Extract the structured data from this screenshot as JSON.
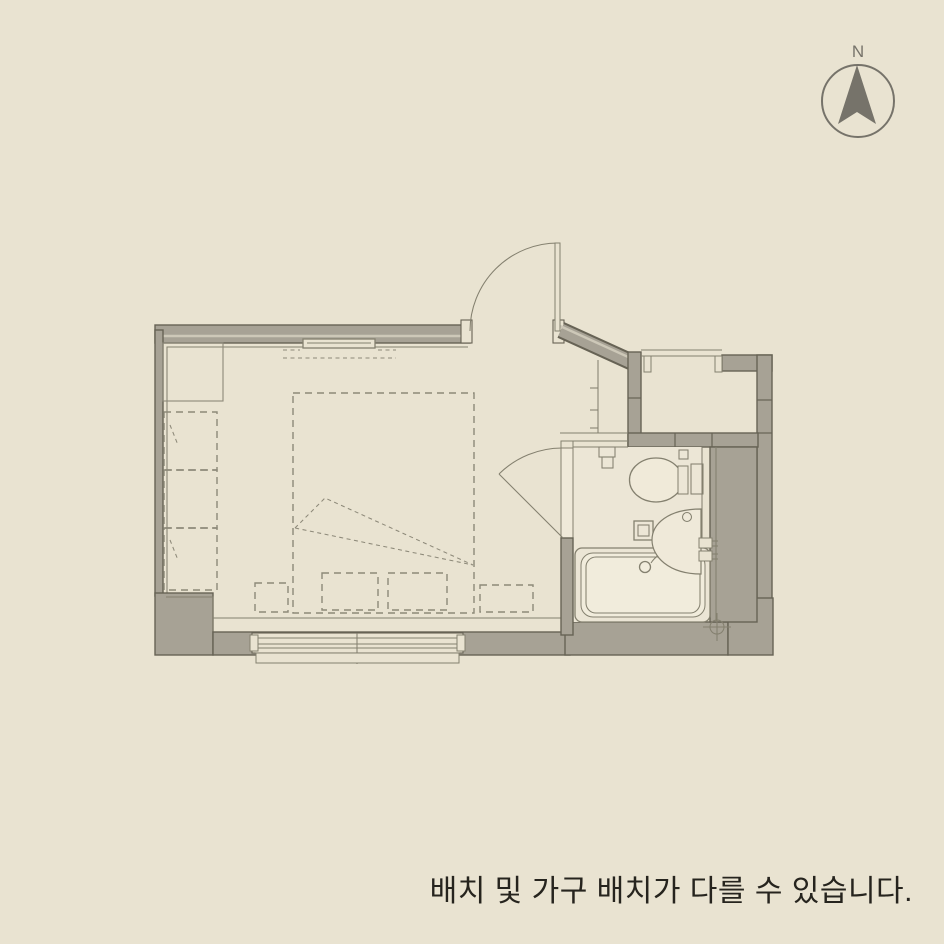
{
  "page": {
    "background_color": "#e9e3d1",
    "caption": "배치 및 가구 배치가 다를 수 있습니다.",
    "caption_color": "#26241e"
  },
  "compass": {
    "label": "N",
    "color": "#76736a"
  },
  "floor_plan": {
    "colors": {
      "wall-fill": "#a7a295",
      "wall-stroke": "#676355",
      "wall-inner-stripe": "#cdc8b8",
      "fixture-line": "#84806f",
      "fixture-fill": "#f0ead9",
      "dashed-line": "#8d8979",
      "bathroom-floor": "#ece6d6",
      "tub-fill": "#ebe5d5",
      "tub-inner": "#f1ecdc",
      "doorway-fill": "#efe9d9"
    },
    "elements": {
      "rooms": [
        "main-room",
        "entry",
        "bathroom",
        "upper-right-room"
      ],
      "fixtures": [
        "north-compass",
        "entrance-door",
        "entry-shoe-shelf",
        "bathroom-door",
        "toilet",
        "toilet-paper-holder",
        "wash-basin",
        "shower-faucet",
        "bathtub",
        "floor-drain",
        "drain-mark",
        "sliding-window",
        "balcony-window-opening",
        "closet",
        "wardrobe-units",
        "bed-outline",
        "bed-fold-mark",
        "wall-shelf"
      ]
    }
  }
}
